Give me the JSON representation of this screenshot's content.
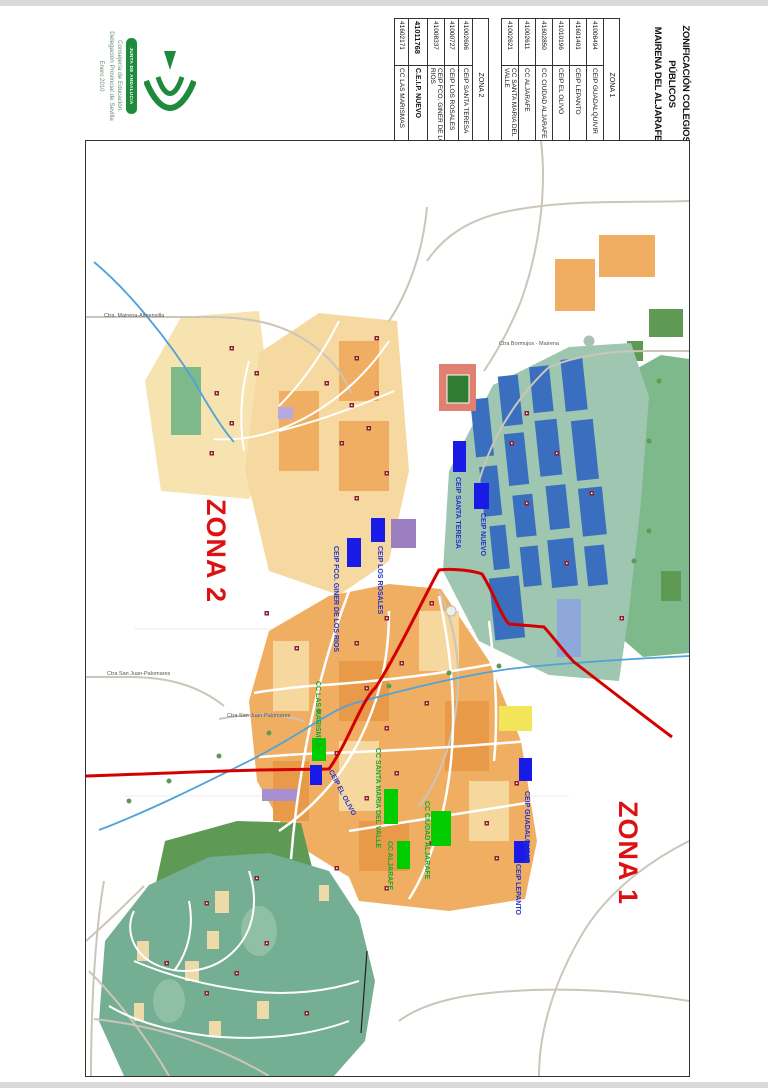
{
  "document": {
    "title_line1": "ZONIFICACIÓN COLEGIOS PÚBLICOS",
    "title_line2": "MAIRENA DEL ALJARAFE"
  },
  "zone_tables": [
    {
      "zone_header": "ZONA 1",
      "rows": [
        {
          "code": "41008494",
          "name": "CEIP GUADALQUIVIR",
          "bold": false
        },
        {
          "code": "41601401",
          "name": "CEIP LEPANTO",
          "bold": false
        },
        {
          "code": "41010196",
          "name": "CEIP EL OLIVO",
          "bold": false
        },
        {
          "code": "41602850",
          "name": "CC CIUDAD ALJARAFE",
          "bold": false
        },
        {
          "code": "41002611",
          "name": "CC ALJARAFE",
          "bold": false
        },
        {
          "code": "41002621",
          "name": "CC SANTA MARIA DEL VALLE",
          "bold": false
        }
      ]
    },
    {
      "zone_header": "ZONA 2",
      "rows": [
        {
          "code": "41002606",
          "name": "CEIP SANTA TERESA",
          "bold": false
        },
        {
          "code": "41000727",
          "name": "CEIP LOS ROSALES",
          "bold": false
        },
        {
          "code": "41008337",
          "name": "CEIP FCO. GINER DE LOS RIOS",
          "bold": false
        },
        {
          "code": "41011768",
          "name": "C.E.I.P. NUEVO",
          "bold": true
        },
        {
          "code": "41602171",
          "name": "CC LAS MARISMAS",
          "bold": false
        }
      ]
    }
  ],
  "logo": {
    "banner_text": "JUNTA DE ANDALUCIA",
    "dept_line1": "Consejería de Educación.",
    "dept_line2": "Delegación Provincial de Sevilla",
    "date_line": "Enero 2010"
  },
  "map": {
    "zone_labels": [
      {
        "text": "ZONA 2"
      },
      {
        "text": "ZONA 1"
      }
    ],
    "school_labels": [
      {
        "text": "CEIP SANTA TERESA",
        "type": "ceip"
      },
      {
        "text": "CEIP NUEVO",
        "type": "ceip"
      },
      {
        "text": "CEIP LOS ROSALES",
        "type": "ceip"
      },
      {
        "text": "CEIP FCO. GINER DE LOS RIOS",
        "type": "ceip"
      },
      {
        "text": "CEIP EL OLIVO",
        "type": "ceip"
      },
      {
        "text": "CEIP GUADALQUIVIR",
        "type": "ceip"
      },
      {
        "text": "CEIP LEPANTO",
        "type": "ceip"
      },
      {
        "text": "CC LAS MARISMAS",
        "type": "cc"
      },
      {
        "text": "CC SANTA MARIA DEL VALLE",
        "type": "cc"
      },
      {
        "text": "CC CIUDAD ALJARAFE",
        "type": "cc"
      },
      {
        "text": "CC ALJARAFE",
        "type": "cc"
      }
    ],
    "road_labels": [
      {
        "text": "Ctra. Mairena-Almensilla"
      },
      {
        "text": "Ctra Bormujos - Mairena"
      },
      {
        "text": "Ctra San Juan-Palomares"
      },
      {
        "text": "Ctra San Juan-Palomares"
      }
    ],
    "colors": {
      "zone_boundary": "#d40000",
      "zone_label": "#dd1111",
      "ceip_marker": "#1a1ae6",
      "cc_marker": "#00cc00",
      "ceip_label": "#2233cc",
      "cc_label": "#11aa33",
      "urban": "#f0ae62",
      "urban_light": "#f5d9a0",
      "residential_teal": "#74ae93",
      "park_green": "#5e9a53",
      "industrial_blue": "#3a6fbf",
      "industrial_bg": "#9ec6b0",
      "water": "#1f86c2"
    }
  }
}
